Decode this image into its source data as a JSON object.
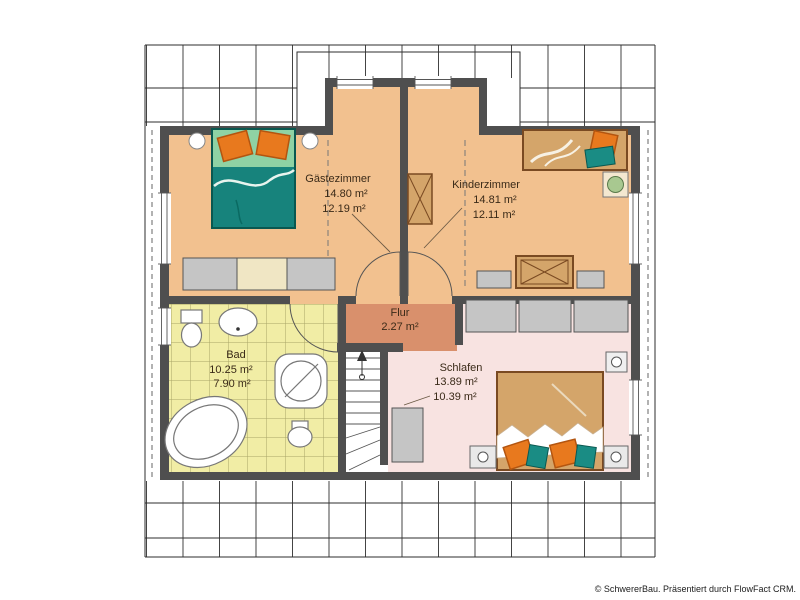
{
  "rooms": {
    "gaestezimmer": {
      "label": "Gästezimmer",
      "area": "14.80 m²",
      "area_reduced": "12.19 m²"
    },
    "kinderzimmer": {
      "label": "Kinderzimmer",
      "area": "14.81 m²",
      "area_reduced": "12.11 m²"
    },
    "flur": {
      "label": "Flur",
      "area": "2.27 m²"
    },
    "bad": {
      "label": "Bad",
      "area": "10.25 m²",
      "area_reduced": "7.90 m²"
    },
    "schlafen": {
      "label": "Schlafen",
      "area": "13.89 m²",
      "area_reduced": "10.39 m²"
    }
  },
  "colors": {
    "wall": "#4f4f4f",
    "floor_gaestezimmer": "#f2c18f",
    "floor_kinderzimmer": "#f2c18f",
    "floor_flur": "#d9906c",
    "floor_bad": "#f1eda5",
    "floor_schlafen": "#f8e3e1",
    "bed_teal": "#17837c",
    "accent_orange": "#e8791e",
    "wood": "#d4a56a",
    "furniture_gray": "#c5c5c5",
    "furniture_cream": "#f0e6c4"
  },
  "footer": {
    "copyright": "© SchwererBau. Präsentiert durch FlowFact CRM."
  }
}
